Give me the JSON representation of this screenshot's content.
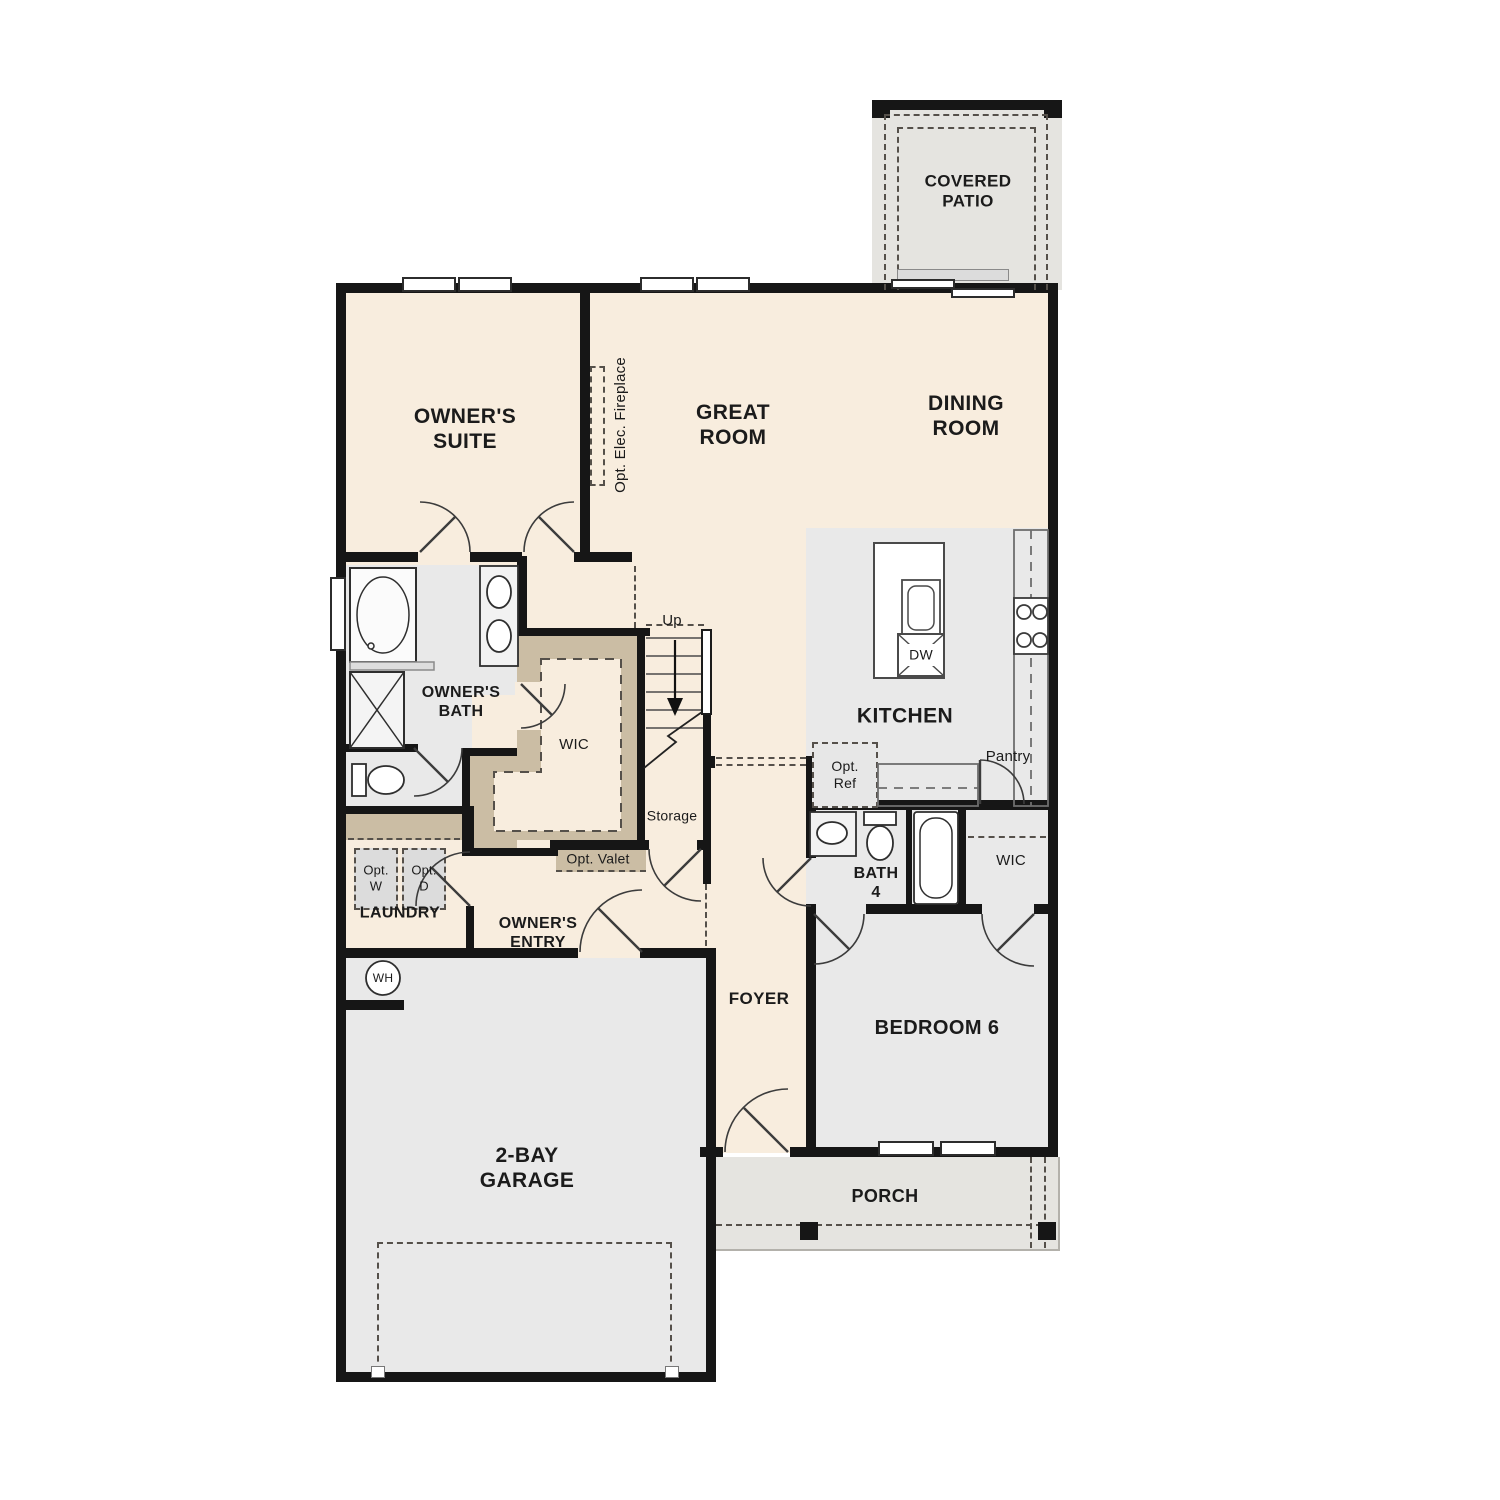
{
  "colors": {
    "wall": "#161616",
    "cream": "#f8edde",
    "gray": "#e9e9e9",
    "outdoor": "#e5e4e0",
    "tan": "#cbbda4"
  },
  "labels": {
    "covered_patio": "COVERED\nPATIO",
    "owners_suite": "OWNER'S\nSUITE",
    "great_room": "GREAT\nROOM",
    "dining_room": "DINING\nROOM",
    "opt_elec_fireplace": "Opt. Elec. Fireplace",
    "kitchen": "KITCHEN",
    "dw": "DW",
    "opt_ref": "Opt.\nRef",
    "pantry": "Pantry",
    "owners_bath": "OWNER'S\nBATH",
    "wic_owners": "WIC",
    "up": "Up",
    "storage": "Storage",
    "opt_valet": "Opt. Valet",
    "opt_w": "Opt.\nW",
    "opt_d": "Opt.\nD",
    "laundry": "LAUNDRY",
    "owners_entry": "OWNER'S\nENTRY",
    "wh": "WH",
    "foyer": "FOYER",
    "bath_4": "BATH\n4",
    "wic_bedroom": "WIC",
    "bedroom_6": "BEDROOM 6",
    "garage": "2-BAY\nGARAGE",
    "porch": "PORCH"
  }
}
